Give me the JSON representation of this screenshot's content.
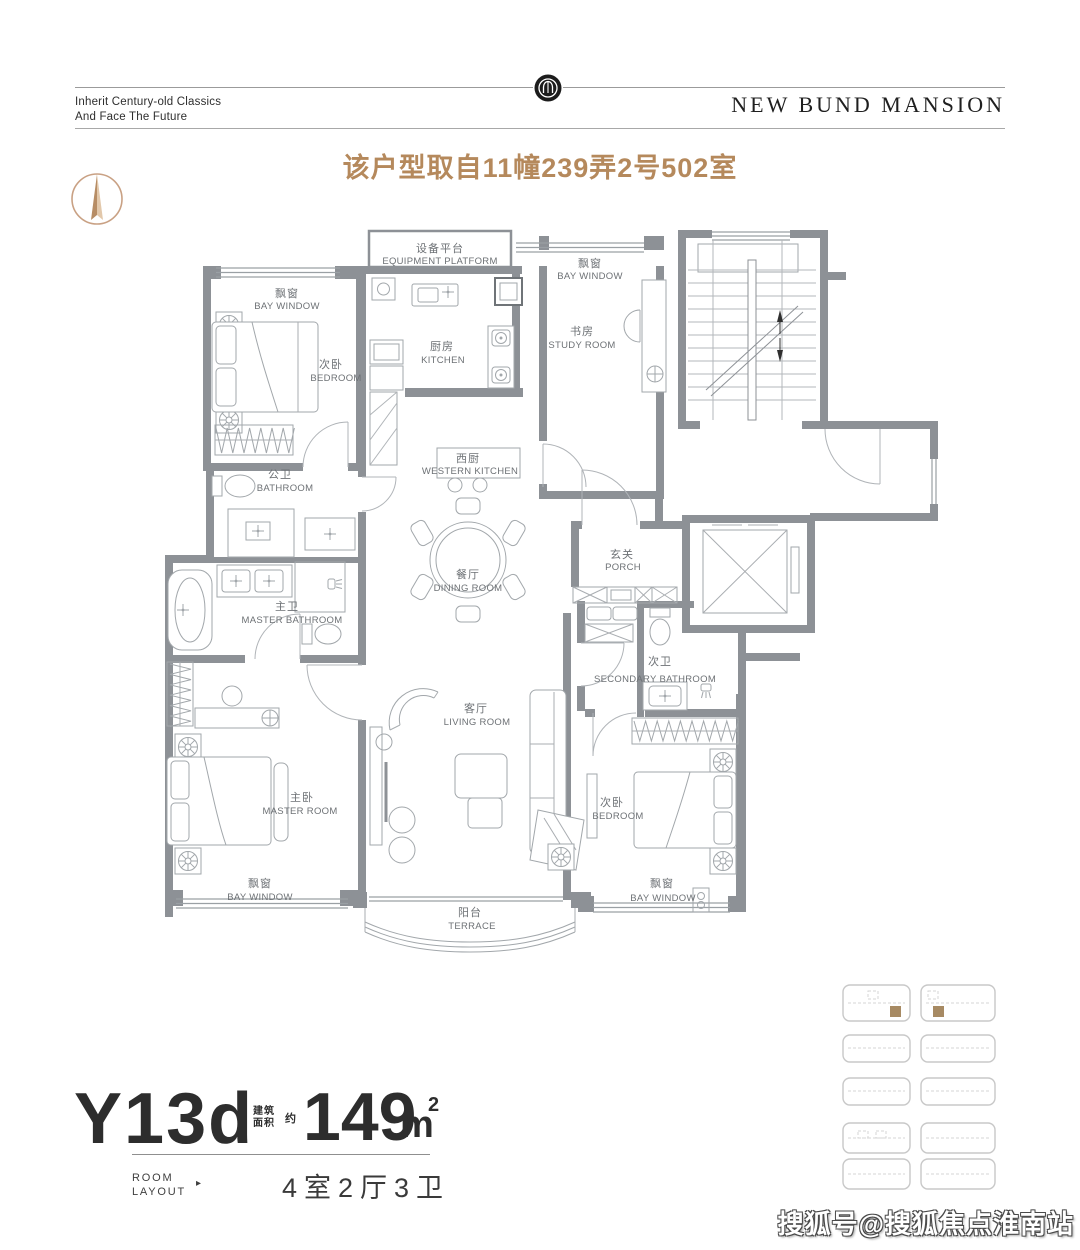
{
  "header": {
    "tagline_line1": "Inherit Century-old Classics",
    "tagline_line2": "And Face The Future",
    "brand": "NEW BUND MANSION"
  },
  "page": {
    "title": "该户型取自11幢239弄2号502室"
  },
  "colors": {
    "accent_brown": "#b5895c",
    "wall_gray": "#8d9196",
    "line_gray": "#a9adb1",
    "label_gray": "#6d7175",
    "north_tan": "#c9a184",
    "site_highlight": "#a78a63"
  },
  "floorplan": {
    "rooms": [
      {
        "zh": "设备平台",
        "en": "EQUIPMENT PLATFORM"
      },
      {
        "zh": "飘窗",
        "en": "BAY WINDOW"
      },
      {
        "zh": "次卧",
        "en": "BEDROOM"
      },
      {
        "zh": "厨房",
        "en": "KITCHEN"
      },
      {
        "zh": "飘窗",
        "en": "BAY WINDOW"
      },
      {
        "zh": "书房",
        "en": "STUDY ROOM"
      },
      {
        "zh": "西厨",
        "en": "WESTERN KITCHEN"
      },
      {
        "zh": "公卫",
        "en": "BATHROOM"
      },
      {
        "zh": "餐厅",
        "en": "DINING ROOM"
      },
      {
        "zh": "玄关",
        "en": "PORCH"
      },
      {
        "zh": "主卫",
        "en": "MASTER BATHROOM"
      },
      {
        "zh": "次卫",
        "en": "SECONDARY BATHROOM"
      },
      {
        "zh": "客厅",
        "en": "LIVING ROOM"
      },
      {
        "zh": "主卧",
        "en": "MASTER ROOM"
      },
      {
        "zh": "次卧",
        "en": "BEDROOM"
      },
      {
        "zh": "飘窗",
        "en": "BAY WINDOW"
      },
      {
        "zh": "飘窗",
        "en": "BAY WINDOW"
      },
      {
        "zh": "阳台",
        "en": "TERRACE"
      }
    ]
  },
  "spec": {
    "unit_code": "Y13d",
    "area_prefix_l1": "建筑",
    "area_prefix_l2": "面积",
    "area_approx": "约",
    "area_value": "149",
    "area_unit": "m",
    "area_sup": "2",
    "room_layout_l1": "ROOM",
    "room_layout_l2": "LAYOUT",
    "arrow": "▸",
    "layout_text": "4室2厅3卫"
  },
  "watermark": {
    "text": "搜狐号@搜狐焦点淮南站"
  }
}
